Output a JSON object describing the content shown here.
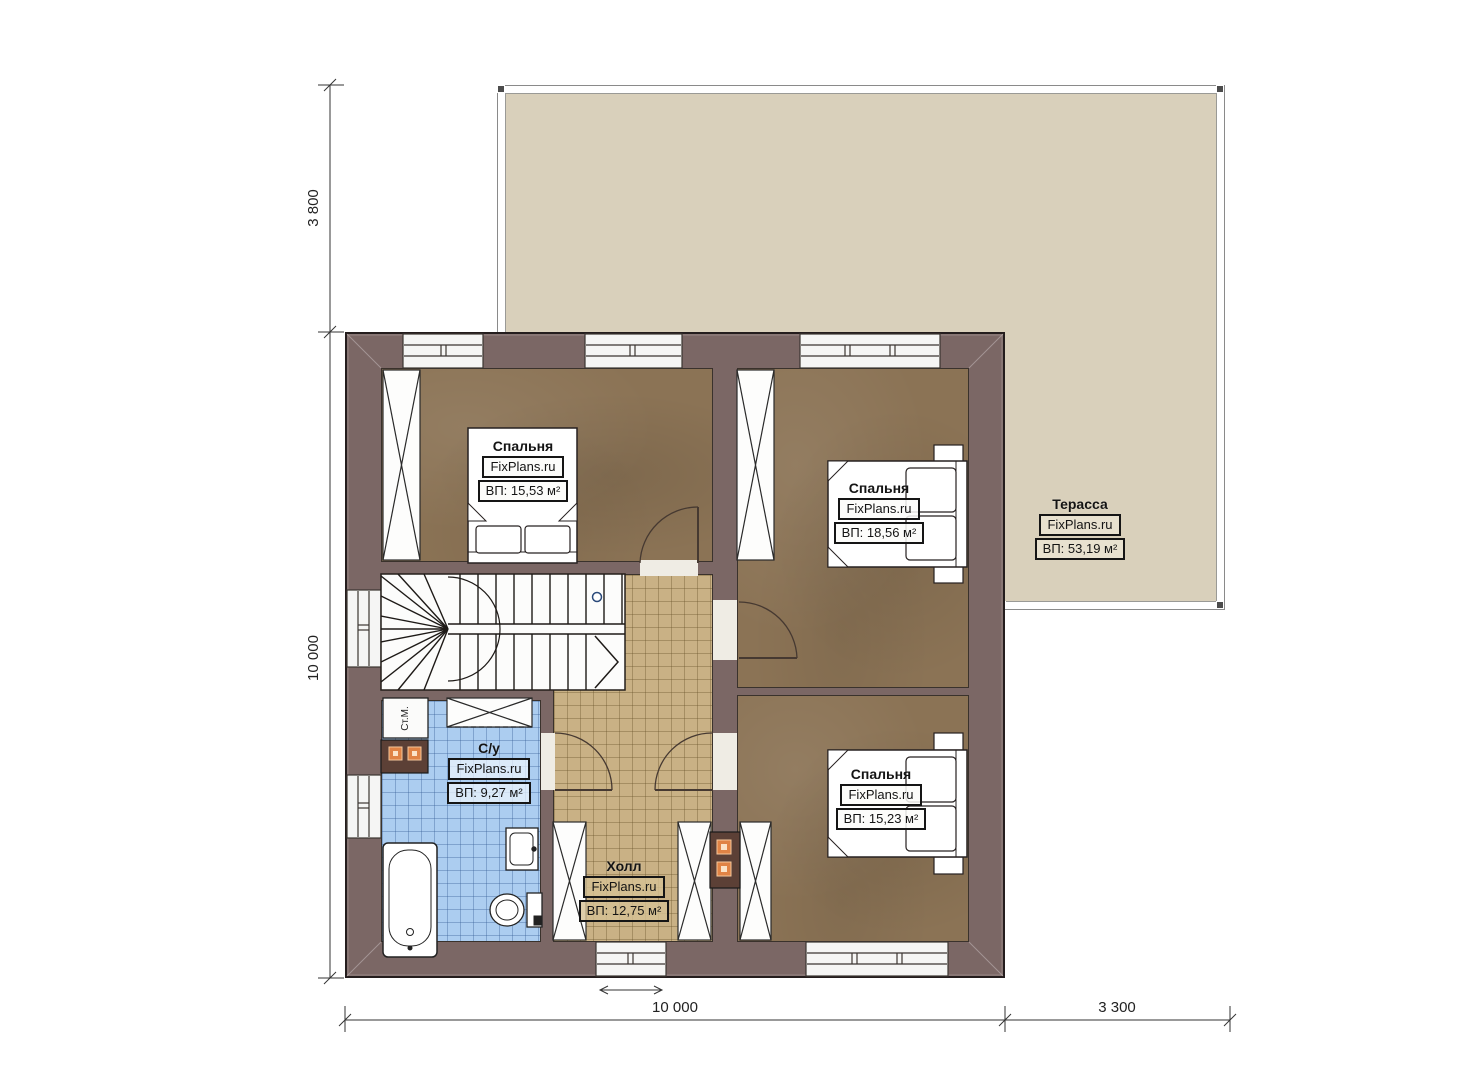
{
  "plan": {
    "rooms": {
      "bedroom1": {
        "name": "Спальня",
        "brand": "FixPlans.ru",
        "area": "ВП: 15,53 м²"
      },
      "bedroom2": {
        "name": "Спальня",
        "brand": "FixPlans.ru",
        "area": "ВП: 18,56 м²"
      },
      "bedroom3": {
        "name": "Спальня",
        "brand": "FixPlans.ru",
        "area": "ВП: 15,23 м²"
      },
      "terrace": {
        "name": "Терасса",
        "brand": "FixPlans.ru",
        "area": "ВП: 53,19 м²"
      },
      "bathroom": {
        "name": "С/у",
        "brand": "FixPlans.ru",
        "area": "ВП: 9,27 м²"
      },
      "hall": {
        "name": "Холл",
        "brand": "FixPlans.ru",
        "area": "ВП: 12,75 м²"
      }
    },
    "appliances": {
      "washing_machine": "Ст.М."
    },
    "dimensions": {
      "left_top": "3 800",
      "left_main": "10 000",
      "bottom_main": "10 000",
      "bottom_right": "3 300"
    },
    "colors": {
      "wall": "#7b6765",
      "bedroom_floor": "#8b7355",
      "hall_floor": "#c9b185",
      "bathroom_floor": "#accdf0",
      "terrace_floor": "#d9d0bb",
      "accent_orange": "#e08345"
    }
  }
}
